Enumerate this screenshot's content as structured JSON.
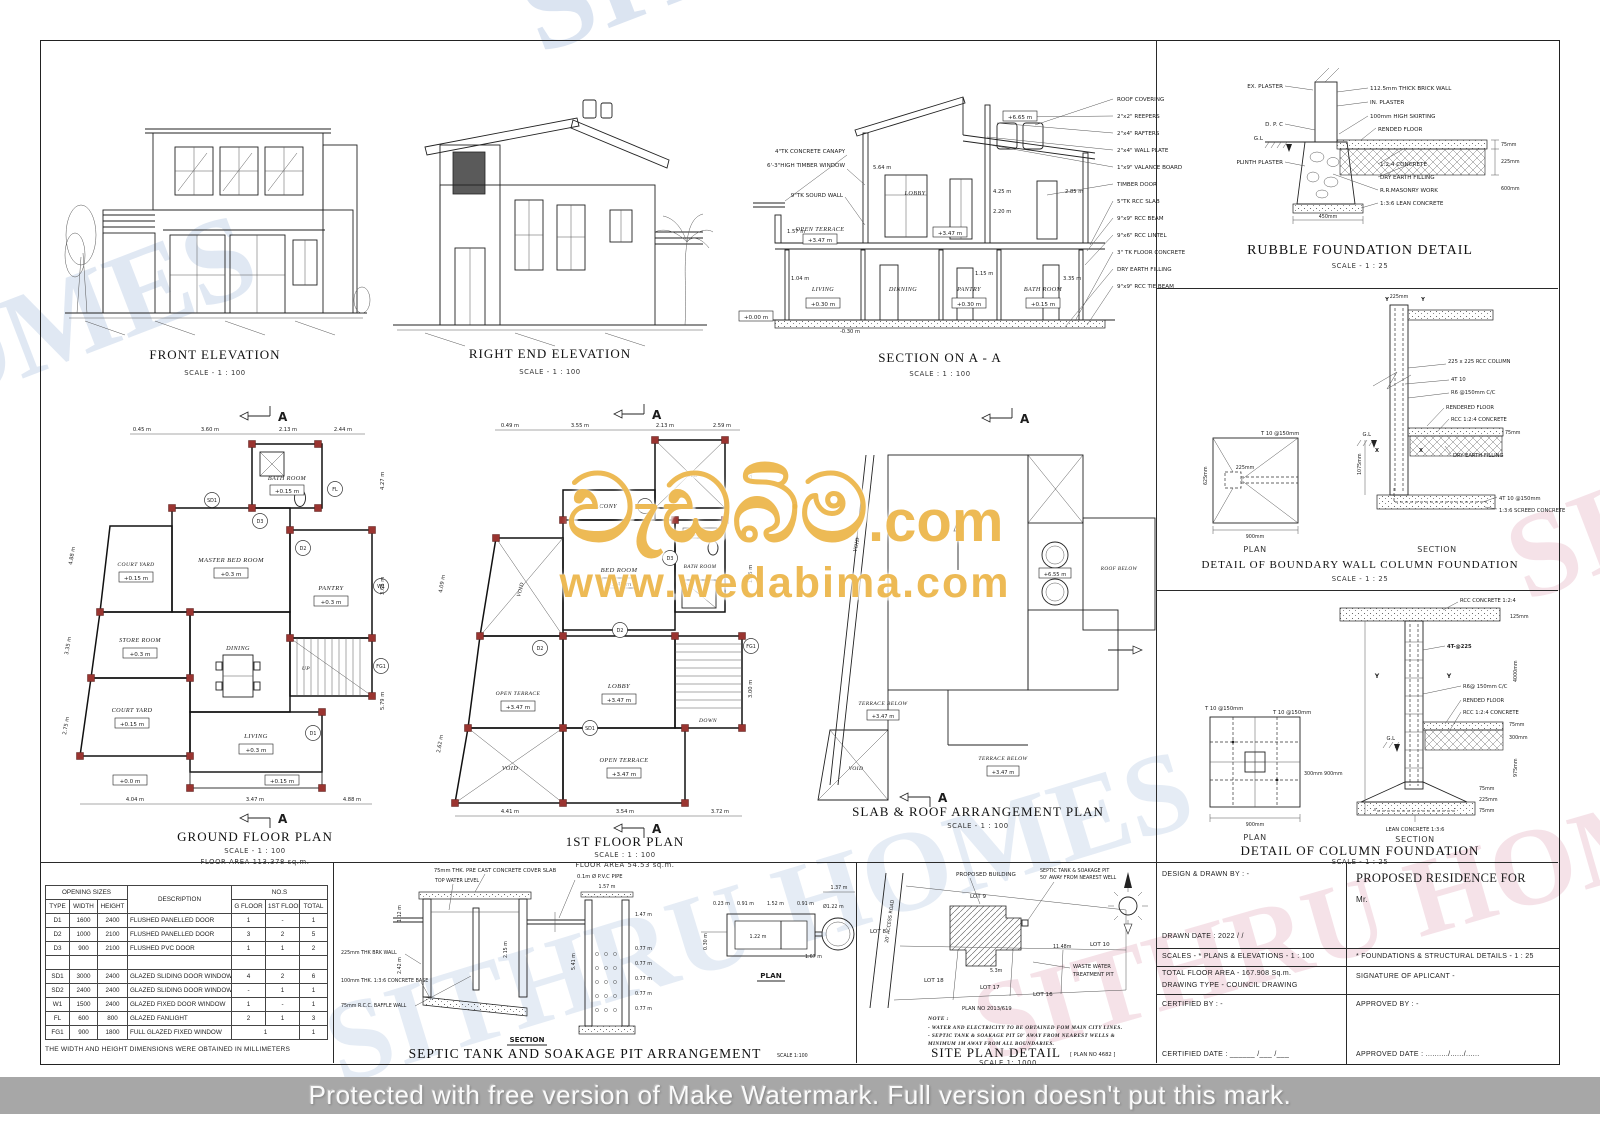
{
  "misc": {
    "marker": "A",
    "up": "UP",
    "down": "DOWN",
    "north": "N",
    "plan_label": "PLAN",
    "section_label": "SECTION"
  },
  "front": {
    "title": "FRONT ELEVATION",
    "scale": "SCALE - 1 : 100"
  },
  "relev": {
    "title": "RIGHT END ELEVATION",
    "scale": "SCALE - 1 : 100"
  },
  "section": {
    "title": "SECTION ON A - A",
    "scale": "SCALE : 1 : 100",
    "left": [
      "4\"TK CONCRETE CANAPY",
      "6'-3\"HIGH TIMBER WINDOW",
      "9\"TK SOURD WALL"
    ],
    "right": [
      "ROOF COVERING",
      "2\"x2\" REEPERS",
      "2\"x4\" RAFTERS",
      "2\"x4\" WALL PLATE",
      "1\"x9\" VALANCE BOARD",
      "TIMBER DOOR",
      "5\"TK RCC SLAB",
      "9\"x9\" RCC BEAM",
      "9\"x6\" RCC LINTEL",
      "3\" TK FLOOR CONCRETE",
      "DRY EARTH FILLING",
      "9\"x9\" RCC TIE BEAM"
    ],
    "r_terrace": "OPEN TERRACE",
    "r_lobby": "LOBBY",
    "r_living": "LIVING",
    "r_dinning": "DINNING",
    "r_pantry": "PANTRY",
    "r_bath": "BATH ROOM",
    "lvl_347": "+3.47 m",
    "lvl_030": "+0.30 m",
    "lvl_015": "+0.15 m",
    "lvl_000": "+0.00 m",
    "lvl_m030": "-0.30 m",
    "lvl_665": "+6.65 m",
    "d_564": "5.64 m",
    "d_425": "4.25 m",
    "d_220": "2.20 m",
    "d_285": "2.85 m",
    "d_157": "1.57 m",
    "d_104": "1.04 m",
    "d_115": "1.15 m",
    "d_335": "3.35 m"
  },
  "ground": {
    "title": "GROUND FLOOR PLAN",
    "scale": "SCALE - 1 : 100",
    "area": "FLOOR AREA  113.378 sq.m.",
    "r_bath": "BATH ROOM",
    "r_master": "MASTER BED ROOM",
    "r_court": "COURT YARD",
    "r_pantry": "PANTRY",
    "r_store": "STORE ROOM",
    "r_dining": "DINING",
    "r_living": "LIVING",
    "lvl03": "+0.3 m",
    "lvl015": "+0.15 m",
    "lvl00": "+0.0 m",
    "dims_top": [
      "0.45 m",
      "3.60 m",
      "2.13 m",
      "2.44 m"
    ],
    "dims_bottom": [
      "4.04 m",
      "3.47 m",
      "4.88 m"
    ],
    "dims_right": [
      "4.27 m",
      "3.66 m",
      "5.79 m"
    ],
    "dims_left": [
      "4.88 m",
      "3.35 m",
      "2.75 m"
    ],
    "tags": {
      "sd1": "SD1",
      "d1": "D1",
      "d2": "D2",
      "d3": "D3",
      "w1": "W1",
      "fl": "FL",
      "fg1": "FG1"
    }
  },
  "first": {
    "title": "1ST FLOOR PLAN",
    "scale": "SCALE : 1 : 100",
    "area": "FLOOR AREA  54.53 sq.m.",
    "r_balcony": "BALCONY",
    "r_void": "VOID",
    "r_bed": "BED ROOM",
    "r_bath": "BATH ROOM",
    "r_terrace": "OPEN TERRACE",
    "r_lobby": "LOBBY",
    "lvl": "+3.47 m",
    "dims_top": [
      "0.49 m",
      "3.55 m",
      "2.13 m",
      "2.59 m"
    ],
    "dims_bottom": [
      "4.41 m",
      "3.54 m",
      "3.72 m"
    ],
    "dims_right": [
      "2.55 m",
      "1.35 m",
      "3.00 m"
    ],
    "dims_left": [
      "4.09 m",
      "2.62 m"
    ],
    "tags": {
      "sd1": "SD1",
      "sd2": "SD2",
      "d2": "D2",
      "d3": "D3",
      "fg1": "FG1"
    }
  },
  "slab": {
    "title": "SLAB & ROOF ARRANGEMENT  PLAN",
    "scale": "SCALE - 1 : 100",
    "r_void": "VOID",
    "r_terrace": "TERRACE BELOW",
    "r_roof": "ROOF BELOW",
    "lvl": "+3.47 m",
    "lvl_tank": "+6.55 m"
  },
  "rubble": {
    "title": "RUBBLE FOUNDATION DETAIL",
    "scale": "SCALE - 1 : 25",
    "l_ex": "EX. PLASTER",
    "l_brick": "112.5mm THICK BRICK WALL",
    "l_in": "IN. PLASTER",
    "l_skirt": "100mm HIGH SKIRTING",
    "l_rend": "RENDED FLOOR",
    "l_dpc": "D. P. C",
    "l_gl": "G.L",
    "l_plinth": "PLINTH PLASTER",
    "l_124": "1:2:4 CONCRETE",
    "l_earth": "DRY EARTH FILLING",
    "l_rr": "R.R.MASONRY WORK",
    "l_lean": "1:3:6 LEAN CONCRETE",
    "d_75": "75mm",
    "d_225": "225mm",
    "d_600": "600mm",
    "d_450": "450mm"
  },
  "boundary": {
    "title": "DETAIL OF BOUNDARY WALL COLUMN FOUNDATION",
    "scale": "SCALE - 1 : 25",
    "l_col": "225 x 225 RCC COLUMN",
    "l_4t10": "4T 10",
    "l_r6": "R6 @150mm C/C",
    "l_rend": "RENDERED FLOOR",
    "l_rcc": "RCC 1:2:4 CONCRETE",
    "l_earth": "DRY EARTH FILLING",
    "l_4t10b": "4T 10 @150mm",
    "l_screed": "1:3:6 SCREED CONCRETE",
    "l_gl": "G.L",
    "l_t10": "T 10 @150mm",
    "d_900": "900mm",
    "d_225": "225mm",
    "d_625": "625mm",
    "d_1075": "1075mm",
    "d_75": "75mm",
    "mx": "X",
    "my": "Y"
  },
  "column": {
    "title": "DETAIL OF COLUMN FOUNDATION",
    "scale": "SCALE - 1 : 25",
    "l_rcctop": "RCC CONCRETE 1:2:4",
    "l_4t": "4T-@225",
    "l_r6": "R6@ 150mm C/C",
    "l_rend": "RENDED FLOOR",
    "l_rcc": "RCC 1:2:4 CONCRETE",
    "l_lean": "LEAN CONCRETE 1:3:6",
    "l_gl": "G.L",
    "l_t10a": "T 10 @150mm",
    "l_t10b": "T 10 @150mm",
    "d_125": "125mm",
    "d_4000": "4000mm",
    "d_75": "75mm",
    "d_300": "300mm",
    "d_975": "975mm",
    "d_225": "225mm",
    "d_pl": "300mm 900mm",
    "d_900": "900mm",
    "my": "Y"
  },
  "septic": {
    "title": "SEPTIC TANK AND SOAKAGE PIT ARRANGEMENT",
    "scale": "SCALE 1:100",
    "l_cover": "75mm THK. PRE CAST CONCRETE COVER SLAB",
    "l_twl": "TOP WATER LEVEL",
    "l_pipe": "0.1m Ø P.V.C PIPE",
    "l_brk": "225mm THK BRK WALL",
    "l_base": "100mm THK. 1:3:6 CONCRETE BASE",
    "l_baffle": "75mm R.C.C. BAFFLE WALL",
    "d_112": "1.12 m",
    "d_242": "2.42 m",
    "d_215": "2.15 m",
    "d_541": "5.41 m",
    "d_157": "1.57 m",
    "d_147": "1.47 m",
    "d_077": "0.77 m",
    "p_023": "0.23 m",
    "p_091": "0.91 m",
    "p_152": "1.52 m",
    "p_122": "1.22 m",
    "p_dia": "Ø1.22 m",
    "p_167": "1.67 m",
    "p_137": "1.37 m",
    "p_030": "0.30 m"
  },
  "site": {
    "title": "SITE PLAN DETAIL",
    "plan_ref": "[ PLAN NO 4682 ]",
    "scale": "SCALE 1: 1000",
    "l_prop": "PROPOSED BUILDING",
    "l_sep1": "SEPTIC TANK & SOAKAGE PIT",
    "l_sep2": "50' AWAY FROM NEAREST WELL",
    "l_road": "20' ACCESS ROAD",
    "lot8": "LOT 8",
    "lot9": "LOT 9",
    "lot10": "LOT 10",
    "lot16": "LOT 16",
    "lot17": "LOT 17",
    "lot18": "LOT 18",
    "l_waste1": "WASTE WATER",
    "l_waste2": "TREATMENT PIT",
    "l_planno": "PLAN NO 2013/619",
    "d_1148": "11.48m",
    "d_53": "5.3m",
    "note_t": "NOTE :",
    "note1": "- WATER AND ELECTRICITY TO BE OBTAINED FOM MAIN CITY LINES.",
    "note2": "- SEPTIC TANK & SOAKAGE PIT 50' AWAY FROM NEAREST WELLS &",
    "note3": "MINIMUM 1M AWAY FROM ALL BOUNDARIES."
  },
  "schedule": {
    "title": "SCHEDULE OF DOORS & WINDOWS",
    "note": "THE WIDTH AND HEIGHT DIMENSIONS WERE OBTAINED IN MILLIMETERS",
    "h_opening": "OPENING SIZES",
    "h_desc": "DESCRIPTION",
    "h_nos": "NO.S",
    "h_type": "TYPE",
    "h_width": "WIDTH",
    "h_height": "HEIGHT",
    "h_gf": "G FLOOR",
    "h_1f": "1ST FLOOR",
    "h_total": "TOTAL",
    "rows": [
      [
        "D1",
        "1600",
        "2400",
        "FLUSHED PANELLED DOOR",
        "1",
        "-",
        "1"
      ],
      [
        "D2",
        "1000",
        "2100",
        "FLUSHED PANELLED DOOR",
        "3",
        "2",
        "5"
      ],
      [
        "D3",
        "900",
        "2100",
        "FLUSHED PVC DOOR",
        "1",
        "1",
        "2"
      ],
      [
        "",
        "",
        "",
        "",
        "",
        "",
        ""
      ],
      [
        "SD1",
        "3000",
        "2400",
        "GLAZED SLIDING DOOR WINDOW",
        "4",
        "2",
        "6"
      ],
      [
        "SD2",
        "2400",
        "2400",
        "GLAZED SLIDING DOOR WINDOW",
        "-",
        "1",
        "1"
      ],
      [
        "W1",
        "1500",
        "2400",
        "GLAZED FIXED DOOR WINDOW",
        "1",
        "-",
        "1"
      ],
      [
        "FL",
        "600",
        "800",
        "GLAZED FANLIGHT",
        "2",
        "1",
        "3"
      ],
      [
        "FG1",
        "900",
        "1800",
        "FULL GLAZED FIXED WINDOW",
        {
          "t": "1",
          "cs": 2
        },
        "1"
      ]
    ]
  },
  "titleblock": {
    "design_by": "DESIGN & DRAWN BY : -",
    "drawn_date": "DRAWN DATE : 2022 /      /",
    "residence": "PROPOSED RESIDENCE FOR",
    "client": "Mr.",
    "scales_left": "SCALES - * PLANS & ELEVATIONS - 1 : 100",
    "scales_right": "* FOUNDATIONS & STRUCTURAL DETAILS - 1 : 25",
    "floor_area": "TOTAL FLOOR AREA - 167.908 Sq.m.",
    "drawing_type": "DRAWING TYPE - COUNCIL DRAWING",
    "signature": "SIGNATURE OF APLICANT -",
    "certified_by": "CERTIFIED BY : -",
    "certified_date": "CERTIFIED DATE : ______ /___ /___",
    "approved_by": "APPROVED BY : -",
    "approved_date": "APPROVED DATE : ........../....../......"
  },
  "watermark": {
    "main": "වැඩබිම",
    "com": ".com",
    "url": "www.wedabima.com",
    "diag": "SITHRU HOMES",
    "bottom": "Protected with free version of Make Watermark. Full version doesn't put this mark."
  }
}
